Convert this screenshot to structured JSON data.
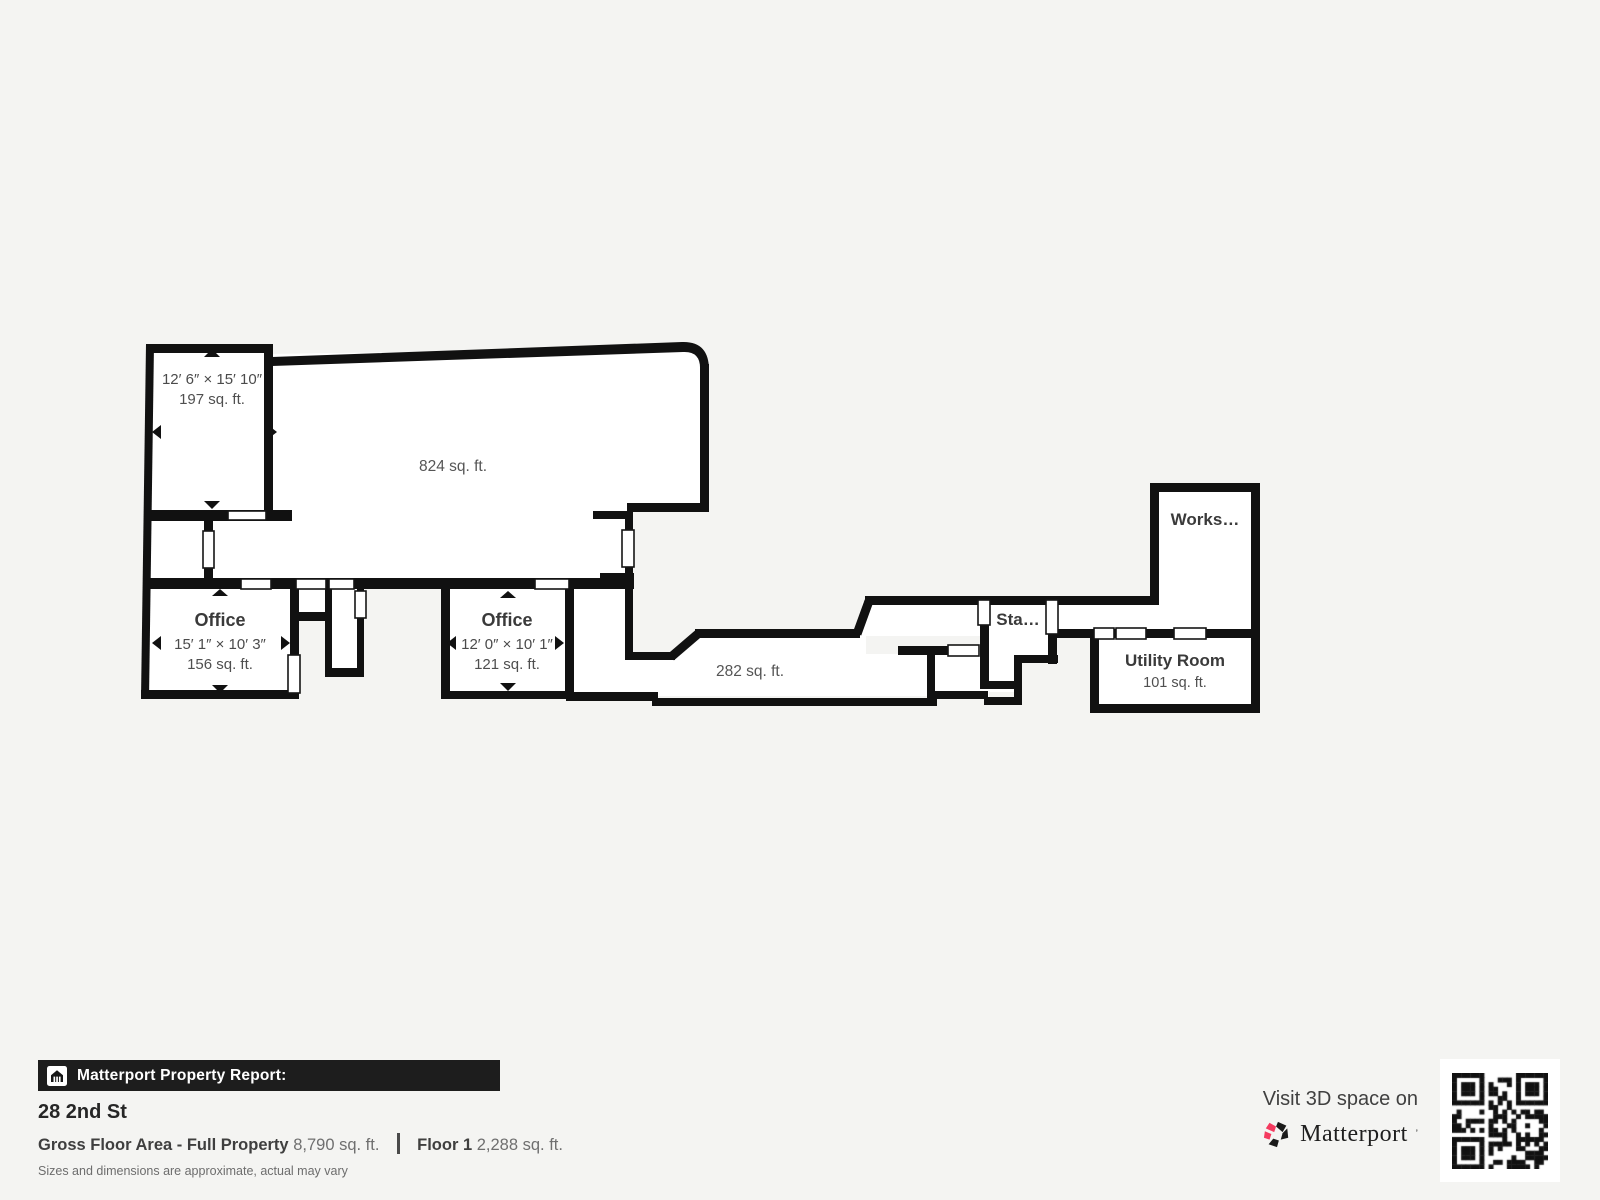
{
  "floorplan": {
    "rooms": {
      "room_197": {
        "dims": "12′ 6″ × 15′ 10″",
        "area": "197 sq. ft."
      },
      "open_824": {
        "area": "824 sq. ft."
      },
      "office_156": {
        "name": "Office",
        "dims": "15′ 1″ × 10′ 3″",
        "area": "156 sq. ft."
      },
      "office_121": {
        "name": "Office",
        "dims": "12′ 0″ × 10′ 1″",
        "area": "121 sq. ft."
      },
      "hall_282": {
        "area": "282 sq. ft."
      },
      "stairs": {
        "name": "Sta…"
      },
      "workshop": {
        "name": "Works…"
      },
      "utility": {
        "name": "Utility Room",
        "area": "101 sq. ft."
      }
    }
  },
  "report": {
    "badge": "Matterport Property Report:",
    "address": "28 2nd St",
    "gross_label": "Gross Floor Area - Full Property",
    "gross_value": "8,790 sq. ft.",
    "floor_label": "Floor 1",
    "floor_value": "2,288 sq. ft.",
    "disclaimer": "Sizes and dimensions are approximate, actual may vary"
  },
  "promo": {
    "visit": "Visit 3D space on",
    "brand": "Matterport"
  },
  "colors": {
    "background": "#f4f4f2",
    "wall": "#111111",
    "brand_pink": "#f43a5f",
    "bar_background": "#1d1d1d"
  }
}
